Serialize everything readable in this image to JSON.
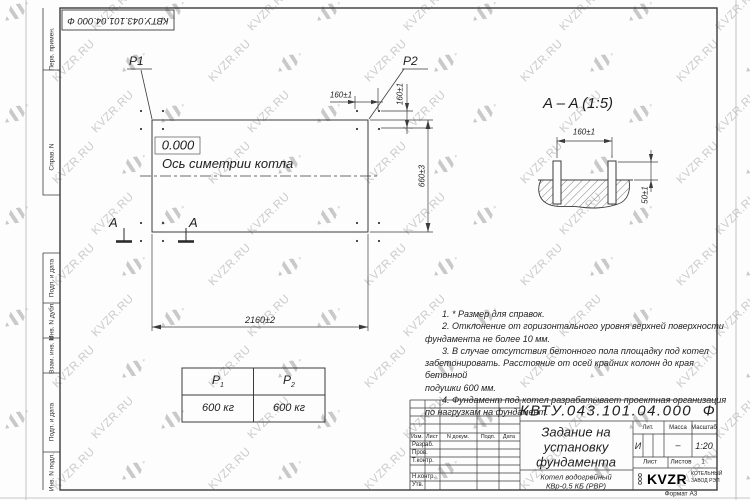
{
  "colors": {
    "ink": "#3b3b3b",
    "watermark": "#c9c9c9"
  },
  "watermark": {
    "text": "KVZR.RU"
  },
  "sheet": {
    "stamp_text": "КВТУ.043.101.04.000  Ф",
    "format_label": "Формат А3"
  },
  "margin_labels": [
    "Перв. примен.",
    "Справ. N",
    "Подп. и дата",
    "Инв. N дубл.",
    "Взам. инв. N",
    "Подп. и дата",
    "Инв. N подл."
  ],
  "plan": {
    "p1": "P1",
    "p2": "P2",
    "zero_level": "0.000",
    "axis_label": "Ось симетрии котла",
    "section_letter": "A",
    "dim_width": "2160±2",
    "dim_height": "660±3",
    "dim_bolt_horizontal": "160±1",
    "dim_bolt_vertical": "160±1"
  },
  "section_view": {
    "title": "A – A (1:5)",
    "dim_bolt_spacing": "160±1",
    "dim_bolt_protrusion": "50±1"
  },
  "load_table": {
    "headers": [
      {
        "base": "P",
        "sub": "1"
      },
      {
        "base": "P",
        "sub": "2"
      }
    ],
    "values": [
      "600 кг",
      "600 кг"
    ]
  },
  "notes": {
    "lines": [
      "1. * Размер для справок.",
      "2. Отклонение от горизонтального уровня верхней поверхности",
      "фундамента не более 10 мм.",
      "3. В случае отсутствия бетонного пола площадку под котел",
      "забетонировать. Расстояние от осей крайних колонн до края бетонной",
      "подушки 600 мм.",
      "4. Фундамент под котел разрабатывает проектная организация",
      "по нагрузкам на фундамент."
    ]
  },
  "title_block": {
    "doc_number": "КВТУ.043.101.04.000  Ф",
    "title_lines": [
      "Задание на",
      "установку",
      "фундамента"
    ],
    "product_lines": [
      "Котел водогрейный",
      "КВр-0,5 КБ (РВР)"
    ],
    "header_cols": [
      "Изм.",
      "Лист",
      "N докум.",
      "Подп.",
      "Дата"
    ],
    "rows": [
      "Разраб.",
      "Пров.",
      "Т.контр.",
      "Н.контр.",
      "Утв."
    ],
    "lit_label": "Лит.",
    "lit_value": "И",
    "mass_label": "Масса",
    "mass_value": "–",
    "scale_label": "Масштаб",
    "scale_value": "1:20",
    "sheet_label": "Лист",
    "sheets_label": "Листов",
    "sheets_value": "1",
    "logo": {
      "prefix": "ООО",
      "name": "KVZR",
      "line1": "КОТЕЛЬНЫЙ",
      "line2": "ЗАВОД РЭП"
    }
  }
}
